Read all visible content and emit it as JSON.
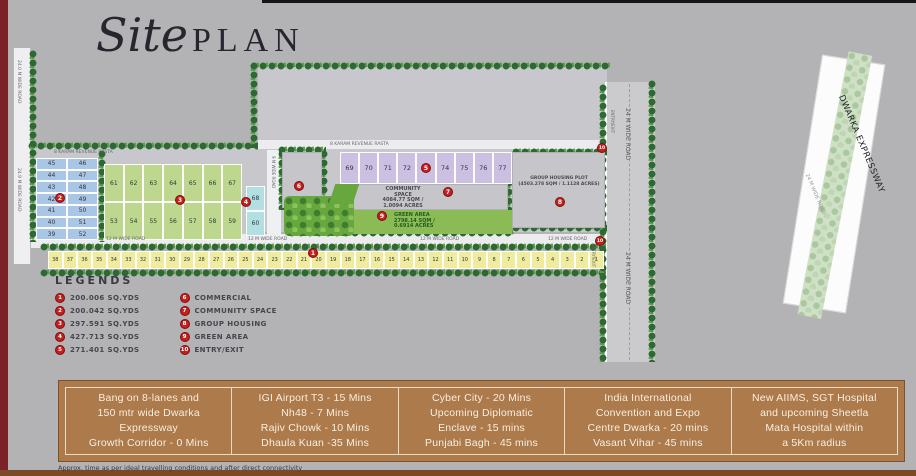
{
  "title": {
    "script": "Site",
    "rest": "PLAN"
  },
  "markers": [
    "1",
    "2",
    "3",
    "4",
    "5",
    "6",
    "7",
    "8",
    "9",
    "10"
  ],
  "plots": {
    "blue_left": [
      "45",
      "44",
      "43",
      "42",
      "41",
      "40",
      "39"
    ],
    "blue_right": [
      "46",
      "47",
      "48",
      "49",
      "50",
      "51",
      "52"
    ],
    "green_top": [
      "61",
      "62",
      "63",
      "64",
      "65",
      "66",
      "67"
    ],
    "green_bottom": [
      "53",
      "54",
      "55",
      "56",
      "57",
      "58",
      "59"
    ],
    "cyan": [
      "68",
      "60"
    ],
    "purple": [
      "69",
      "70",
      "71",
      "72",
      "73",
      "74",
      "75",
      "76",
      "77"
    ],
    "yellow": [
      "38",
      "37",
      "36",
      "35",
      "34",
      "33",
      "32",
      "31",
      "30",
      "29",
      "28",
      "27",
      "26",
      "25",
      "24",
      "23",
      "22",
      "21",
      "20",
      "19",
      "18",
      "17",
      "16",
      "15",
      "14",
      "13",
      "12",
      "11",
      "10",
      "9",
      "8",
      "7",
      "6",
      "5",
      "4",
      "3",
      "2",
      "1"
    ]
  },
  "areas": {
    "community_lines": [
      "COMMUNITY",
      "SPACE",
      "4084.77 SQM /",
      "1.0094 ACRES"
    ],
    "green_area_lines": [
      "GREEN AREA",
      "2798.14 SQM /",
      "0.6914 ACRES"
    ],
    "group_housing_lines": [
      "GROUP HOUSING PLOT",
      "(4503.278 SQM / 1.1128 ACRES)"
    ]
  },
  "roads": {
    "left_upper": "24.0 M WIDE ROAD",
    "left_lower": "24.9 M WIDE ROAD",
    "internal": "9 M WIDE ROAD",
    "right": "24 M WIDE ROAD",
    "twelve": "12 M WIDE ROAD",
    "revenue": "8 KARAM REVENUE RASTA",
    "entry_exit": "ENTRY/EXIT"
  },
  "expressway": {
    "name": "DWARKA EXPRESSWAY",
    "road": "24 M WIDE ROAD"
  },
  "legend": {
    "heading": "LEGENDS",
    "col1": [
      {
        "num": "1",
        "label": "200.006 SQ.YDS"
      },
      {
        "num": "2",
        "label": "200.042 SQ.YDS"
      },
      {
        "num": "3",
        "label": "297.591 SQ.YDS"
      },
      {
        "num": "4",
        "label": "427.713 SQ.YDS"
      },
      {
        "num": "5",
        "label": "271.401 SQ.YDS"
      }
    ],
    "col2": [
      {
        "num": "6",
        "label": "COMMERCIAL"
      },
      {
        "num": "7",
        "label": "COMMUNITY SPACE"
      },
      {
        "num": "8",
        "label": "GROUP HOUSING"
      },
      {
        "num": "9",
        "label": "GREEN AREA"
      },
      {
        "num": "10",
        "label": "ENTRY/EXIT"
      }
    ]
  },
  "highlights": [
    {
      "lines": [
        "Bang on 8-lanes and",
        "150 mtr wide Dwarka",
        "Expressway",
        "Growth Corridor - 0 Mins"
      ]
    },
    {
      "lines": [
        "IGI Airport T3 - 15 Mins",
        "Nh48 - 7 Mins",
        "Rajiv Chowk - 10 Mins",
        "Dhaula Kuan -35 Mins"
      ]
    },
    {
      "lines": [
        "Cyber City - 20 Mins",
        "Upcoming Diplomatic",
        "Enclave - 15 mins",
        "Punjabi Bagh - 45 mins"
      ]
    },
    {
      "lines": [
        "India International",
        "Convention and Expo",
        "Centre Dwarka - 20 mins",
        "Vasant Vihar - 45 mins"
      ]
    },
    {
      "lines": [
        "New AIIMS, SGT Hospital",
        "and upcoming Sheetla",
        "Mata Hospital within",
        "a 5Km radius"
      ]
    }
  ],
  "footnote": "Approx. time as per ideal travelling conditions and after direct connectivity",
  "colors": {
    "background": "#b3b2b5",
    "marker_red": "#c4201d",
    "highlight_brown": "#ac7a4b",
    "plot_yellow": "#efec9f",
    "plot_blue": "#a9c6e6",
    "plot_green": "#bdd88e",
    "plot_purple": "#cbbfe2",
    "plot_cyan": "#b2dfe2",
    "green_area": "#8abb55",
    "maroon_edge": "#7b2228"
  }
}
